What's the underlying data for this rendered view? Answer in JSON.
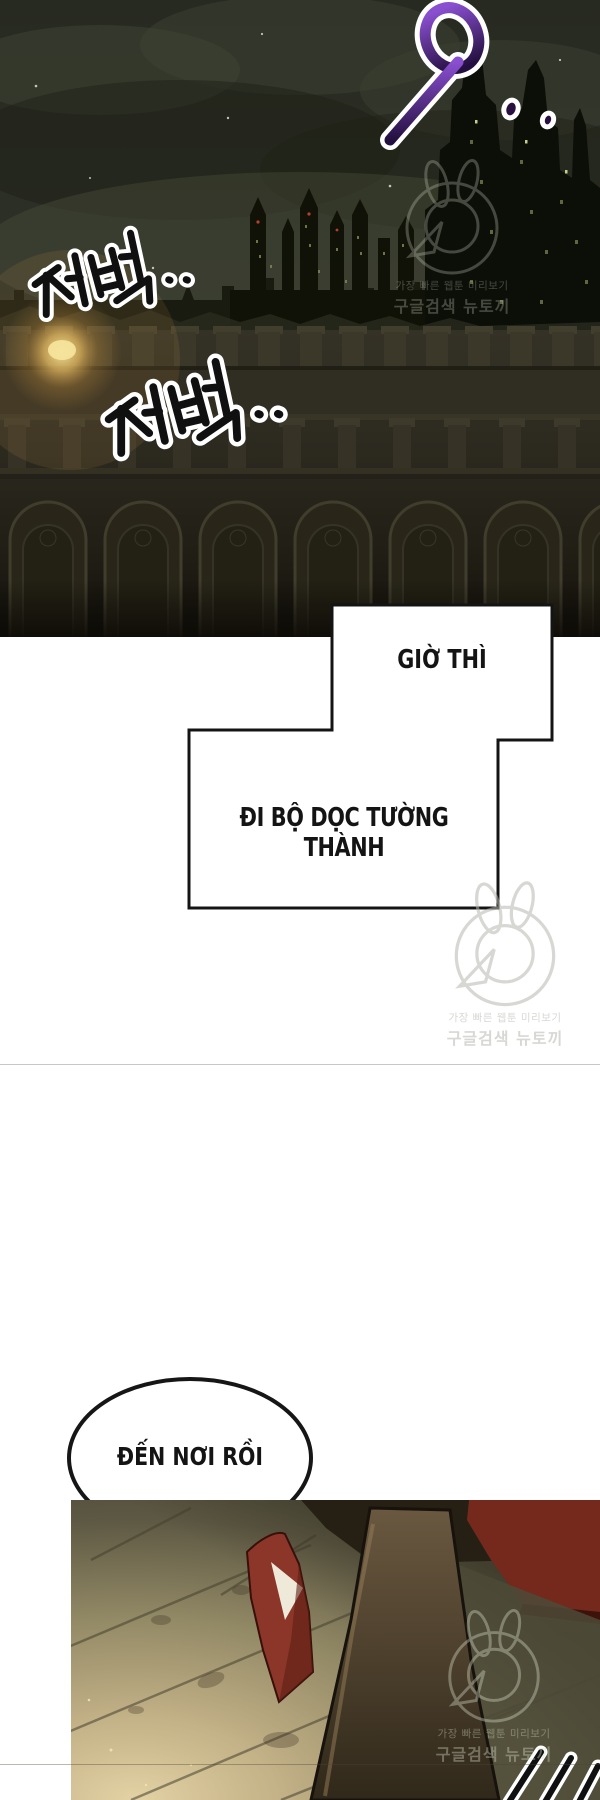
{
  "comic": {
    "sfx": {
      "swish": "9",
      "footsteps_1": "저벅..",
      "footsteps_2": "저벅.."
    },
    "captions": {
      "caption_1": "GIỜ THÌ",
      "caption_2": "ĐI BỘ DỌC TƯỜNG THÀNH"
    },
    "speech": {
      "arrival": "ĐẾN NƠI RỒI"
    },
    "watermark": {
      "line_1": "가장 빠른 웹툰 미리보기",
      "line_2": "구글검색 뉴토끼"
    },
    "colors": {
      "night_sky": "#2e3128",
      "fortress_wall": "#2c2a1f",
      "lantern_glow": "#e8bd62",
      "sfx_purple": "#5b2a8e",
      "cape_red": "#8c3629",
      "pavement_lit": "#d8c79e",
      "panel_border": "#141414"
    }
  }
}
